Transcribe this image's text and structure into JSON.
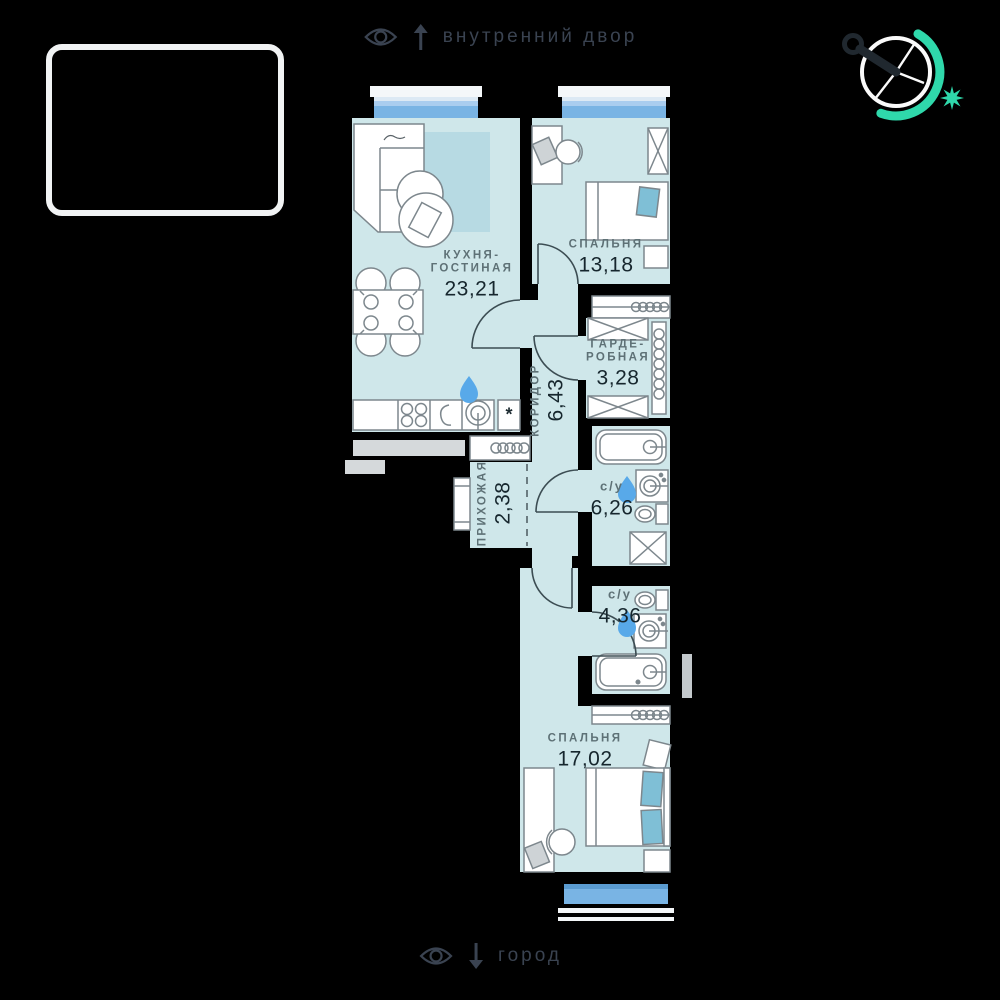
{
  "annotations": {
    "top": {
      "icon": "eye-icon",
      "arrow": "↑",
      "label": "внутренний двор"
    },
    "bottom": {
      "icon": "eye-icon",
      "arrow": "↓",
      "label": "город"
    }
  },
  "rooms": [
    {
      "key": "kitchen-living",
      "name_line1": "КУХНЯ-",
      "name_line2": "ГОСТИНАЯ",
      "area": "23,21"
    },
    {
      "key": "bedroom-1",
      "name_line1": "СПАЛЬНЯ",
      "area": "13,18"
    },
    {
      "key": "wardrobe",
      "name_line1": "ГАРДЕ-",
      "name_line2": "РОБНАЯ",
      "area": "3,28"
    },
    {
      "key": "corridor",
      "name_line1": "КОРИДОР",
      "area": "6,43"
    },
    {
      "key": "hallway",
      "name_line1": "ПРИХОЖАЯ",
      "area": "2,38"
    },
    {
      "key": "bathroom-1",
      "name_line1": "с/у",
      "area": "6,26"
    },
    {
      "key": "bathroom-2",
      "name_line1": "с/у",
      "area": "4,36"
    },
    {
      "key": "bedroom-2",
      "name_line1": "СПАЛЬНЯ",
      "area": "17,02"
    }
  ],
  "plan_symbols": {
    "fridge": "*"
  },
  "colors": {
    "background": "#000000",
    "room_fill": "#cfe7ea",
    "window_glass": "#79b4e4",
    "rug": "#b7dae3",
    "pillow": "#7fbfd6",
    "water_drop": "#58a9e9",
    "accent_teal": "#2fd8ab",
    "annotation_text": "#3a4351",
    "room_name_text": "#5e7176",
    "room_area_text": "#16262d"
  }
}
